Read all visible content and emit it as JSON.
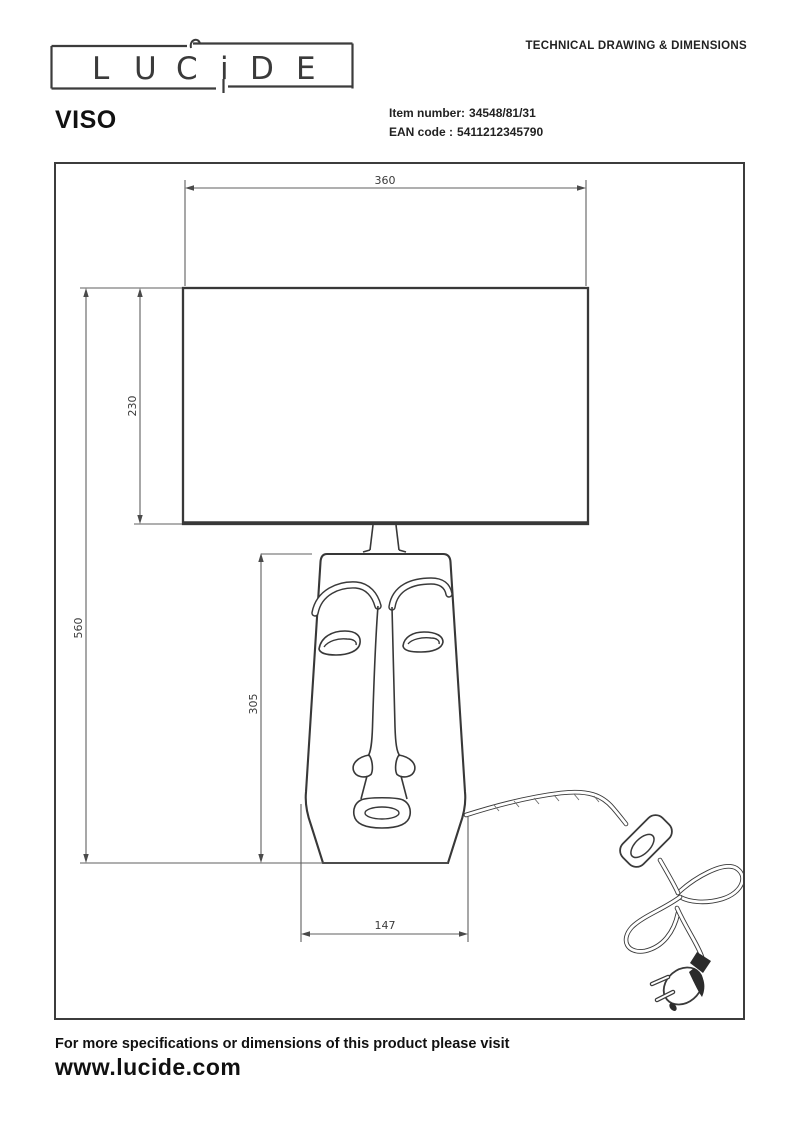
{
  "header": {
    "logo_name": "LUCIDE",
    "logo_letters": [
      "L",
      "U",
      "C",
      "i",
      "D",
      "E"
    ],
    "doc_title": "TECHNICAL DRAWING & DIMENSIONS"
  },
  "product": {
    "name": "VISO",
    "item_number_label": "Item number:",
    "item_number": "34548/81/31",
    "ean_label": "EAN code :",
    "ean_code": "5411212345790"
  },
  "drawing": {
    "dim_shade_width": "360",
    "dim_shade_height": "230",
    "dim_total_height": "560",
    "dim_body_height": "305",
    "dim_base_width": "147"
  },
  "footer": {
    "note": "For more specifications or dimensions of this product please visit",
    "website": "www.lucide.com"
  },
  "colors": {
    "object_line": "#383838",
    "dimension_line": "#5f5f5f",
    "text": "#111111"
  }
}
